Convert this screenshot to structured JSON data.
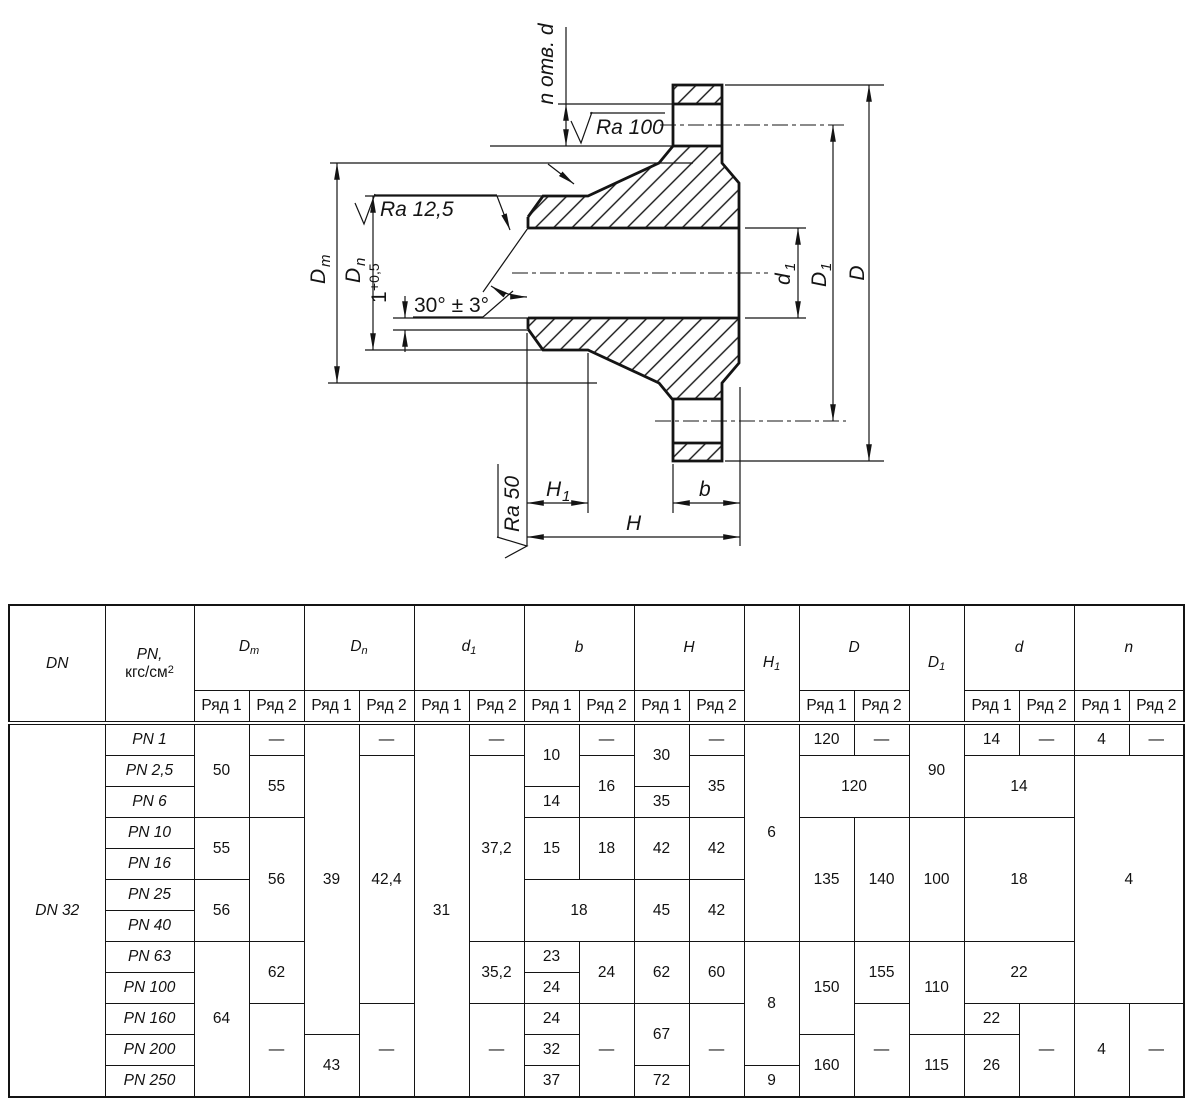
{
  "drawing": {
    "labels": {
      "holes": "n отв. d",
      "ra_top": "Ra 100",
      "ra_bore": "Ra 12,5",
      "ra_end": "Ra 50",
      "angle": "30° ± 3°",
      "land_value": "1",
      "land_tol": "+0,5",
      "dim_dm": {
        "base": "D",
        "sub": "m"
      },
      "dim_dn": {
        "base": "D",
        "sub": "n"
      },
      "dim_d1_small": {
        "base": "d",
        "sub": "1"
      },
      "dim_d1_big": {
        "base": "D",
        "sub": "1"
      },
      "dim_d": "D",
      "dim_h1": {
        "base": "H",
        "sub": "1"
      },
      "dim_h": "H",
      "dim_b": "b"
    }
  },
  "table": {
    "col_widths": [
      96,
      89,
      55,
      55,
      55,
      55,
      55,
      55,
      55,
      55,
      55,
      55,
      55,
      55,
      55,
      55,
      55,
      55,
      55,
      55
    ],
    "header": [
      [
        {
          "v": "DN",
          "it": 1,
          "rs": 2
        },
        {
          "v": "{i}PN,{/i}|кгс/см^2",
          "rs": 2
        },
        {
          "v": "D_m",
          "it": 1,
          "cs": 2
        },
        {
          "v": "D_n",
          "it": 1,
          "cs": 2
        },
        {
          "v": "d_1",
          "it": 1,
          "cs": 2
        },
        {
          "v": "b",
          "it": 1,
          "cs": 2
        },
        {
          "v": "H",
          "it": 1,
          "cs": 2
        },
        {
          "v": "H_1",
          "it": 1,
          "rs": 2
        },
        {
          "v": "D",
          "it": 1,
          "cs": 2
        },
        {
          "v": "D_1",
          "it": 1,
          "rs": 2
        },
        {
          "v": "d",
          "it": 1,
          "cs": 2
        },
        {
          "v": "n",
          "it": 1,
          "cs": 2
        }
      ],
      [
        {
          "v": "Ряд 1"
        },
        {
          "v": "Ряд 2"
        },
        {
          "v": "Ряд 1"
        },
        {
          "v": "Ряд 2"
        },
        {
          "v": "Ряд 1"
        },
        {
          "v": "Ряд 2"
        },
        {
          "v": "Ряд 1"
        },
        {
          "v": "Ряд 2"
        },
        {
          "v": "Ряд 1"
        },
        {
          "v": "Ряд 2"
        },
        {
          "v": "Ряд 1"
        },
        {
          "v": "Ряд 2"
        },
        {
          "v": "Ряд 1"
        },
        {
          "v": "Ряд 2"
        },
        {
          "v": "Ряд 1"
        },
        {
          "v": "Ряд 2"
        }
      ]
    ],
    "body": [
      [
        {
          "v": "DN 32",
          "it": 1,
          "rs": 12,
          "nm": "dn-label"
        },
        {
          "v": "PN 1",
          "it": 1,
          "nm": "pn-label"
        },
        {
          "v": "50",
          "rs": 3
        },
        {
          "v": "—"
        },
        {
          "v": "39",
          "rs": 10
        },
        {
          "v": "—"
        },
        {
          "v": "31",
          "rs": 12
        },
        {
          "v": "—"
        },
        {
          "v": "10",
          "rs": 2
        },
        {
          "v": "—"
        },
        {
          "v": "30",
          "rs": 2
        },
        {
          "v": "—"
        },
        {
          "v": "6",
          "rs": 7
        },
        {
          "v": "120"
        },
        {
          "v": "—"
        },
        {
          "v": "90",
          "rs": 3
        },
        {
          "v": "14"
        },
        {
          "v": "—"
        },
        {
          "v": "4"
        },
        {
          "v": "—"
        }
      ],
      [
        {
          "v": "PN 2,5",
          "it": 1,
          "nm": "pn-label"
        },
        {
          "v": "55",
          "rs": 2
        },
        {
          "v": "42,4",
          "rs": 8
        },
        {
          "v": "37,2",
          "rs": 6
        },
        {
          "v": "16",
          "rs": 2
        },
        {
          "v": "35",
          "rs": 2
        },
        {
          "v": "120",
          "cs": 2,
          "rs": 2
        },
        {
          "v": "14",
          "cs": 2,
          "rs": 2
        },
        {
          "v": "4",
          "cs": 2,
          "rs": 8
        }
      ],
      [
        {
          "v": "PN 6",
          "it": 1,
          "nm": "pn-label"
        },
        {
          "v": "14"
        },
        {
          "v": "35"
        }
      ],
      [
        {
          "v": "PN 10",
          "it": 1,
          "nm": "pn-label"
        },
        {
          "v": "55",
          "rs": 2
        },
        {
          "v": "56",
          "rs": 4
        },
        {
          "v": "15",
          "rs": 2
        },
        {
          "v": "18",
          "rs": 2
        },
        {
          "v": "42",
          "rs": 2
        },
        {
          "v": "42",
          "rs": 2
        },
        {
          "v": "135",
          "rs": 4
        },
        {
          "v": "140",
          "rs": 4
        },
        {
          "v": "100",
          "rs": 4
        },
        {
          "v": "18",
          "cs": 2,
          "rs": 4
        }
      ],
      [
        {
          "v": "PN 16",
          "it": 1,
          "nm": "pn-label"
        }
      ],
      [
        {
          "v": "PN 25",
          "it": 1,
          "nm": "pn-label"
        },
        {
          "v": "56",
          "rs": 2
        },
        {
          "v": "18",
          "cs": 2,
          "rs": 2
        },
        {
          "v": "45",
          "rs": 2
        },
        {
          "v": "42",
          "rs": 2
        }
      ],
      [
        {
          "v": "PN 40",
          "it": 1,
          "nm": "pn-label"
        }
      ],
      [
        {
          "v": "PN 63",
          "it": 1,
          "nm": "pn-label"
        },
        {
          "v": "64",
          "rs": 5
        },
        {
          "v": "62",
          "rs": 2
        },
        {
          "v": "35,2",
          "rs": 2
        },
        {
          "v": "23"
        },
        {
          "v": "24",
          "rs": 2
        },
        {
          "v": "62",
          "rs": 2
        },
        {
          "v": "60",
          "rs": 2
        },
        {
          "v": "8",
          "rs": 4
        },
        {
          "v": "150",
          "rs": 3
        },
        {
          "v": "155",
          "rs": 2
        },
        {
          "v": "110",
          "rs": 3
        },
        {
          "v": "22",
          "cs": 2,
          "rs": 2
        }
      ],
      [
        {
          "v": "PN 100",
          "it": 1,
          "nm": "pn-label"
        },
        {
          "v": "24"
        }
      ],
      [
        {
          "v": "PN 160",
          "it": 1,
          "nm": "pn-label"
        },
        {
          "v": "—",
          "rs": 3
        },
        {
          "v": "—",
          "rs": 3
        },
        {
          "v": "—",
          "rs": 3
        },
        {
          "v": "24"
        },
        {
          "v": "—",
          "rs": 3
        },
        {
          "v": "67",
          "rs": 2
        },
        {
          "v": "—",
          "rs": 3
        },
        {
          "v": "—",
          "rs": 3
        },
        {
          "v": "22"
        },
        {
          "v": "—",
          "rs": 3
        },
        {
          "v": "4",
          "rs": 3
        },
        {
          "v": "—",
          "rs": 3
        }
      ],
      [
        {
          "v": "PN 200",
          "it": 1,
          "nm": "pn-label"
        },
        {
          "v": "43",
          "rs": 2
        },
        {
          "v": "32"
        },
        {
          "v": "160",
          "rs": 2
        },
        {
          "v": "115",
          "rs": 2
        },
        {
          "v": "26",
          "rs": 2
        }
      ],
      [
        {
          "v": "PN 250",
          "it": 1,
          "nm": "pn-label"
        },
        {
          "v": "37"
        },
        {
          "v": "72"
        },
        {
          "v": "9"
        }
      ]
    ]
  }
}
